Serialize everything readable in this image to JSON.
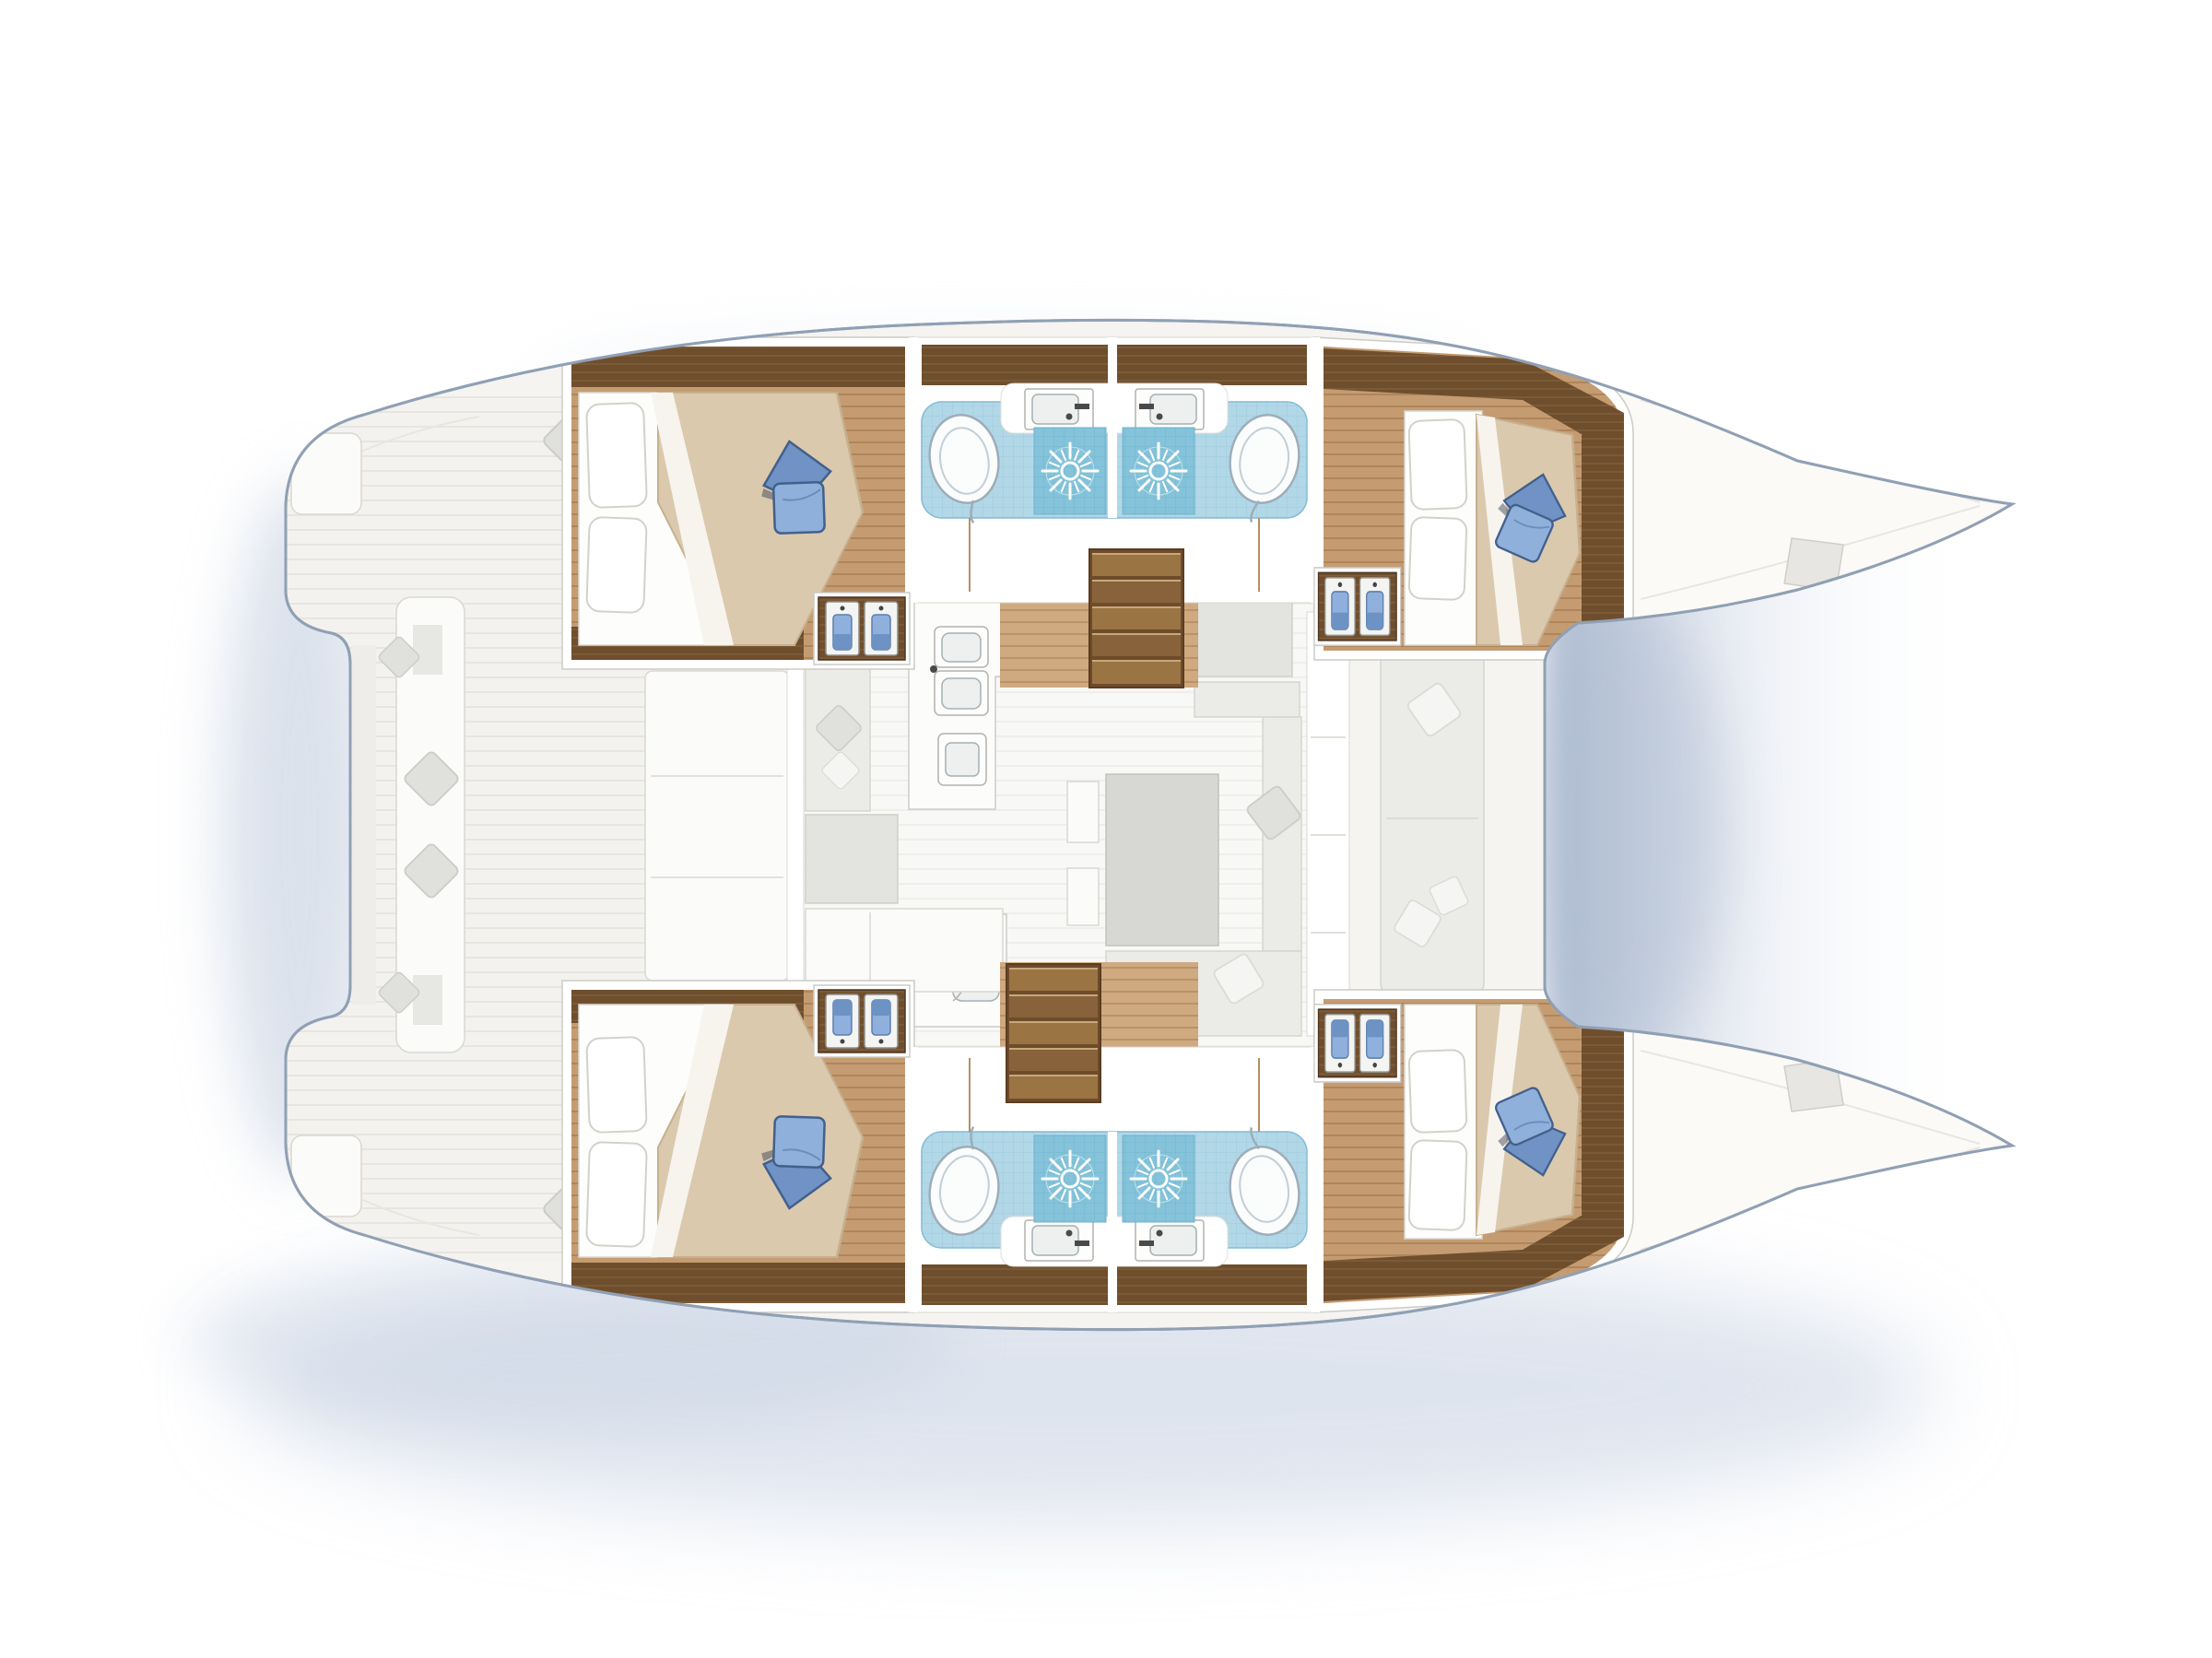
{
  "figure": {
    "type": "floor-plan",
    "subject": "catamaran-yacht-interior-layout-top-view",
    "orientation": "bow-right-stern-left",
    "hulls": 2,
    "rooms": {
      "cabins": [
        {
          "id": "port-aft-cabin",
          "position": "top-left",
          "features": [
            "double-bed",
            "white-pillows",
            "blue-accent-pillow",
            "beige-duvet",
            "wood-floor",
            "wardrobe"
          ]
        },
        {
          "id": "port-forward-cabin",
          "position": "top-right",
          "features": [
            "double-bed",
            "white-pillows",
            "blue-accent-pillow",
            "beige-duvet",
            "wood-floor",
            "wardrobe"
          ]
        },
        {
          "id": "starboard-aft-cabin",
          "position": "bottom-left",
          "features": [
            "double-bed",
            "white-pillows",
            "blue-accent-pillow",
            "beige-duvet",
            "wood-floor",
            "wardrobe"
          ]
        },
        {
          "id": "starboard-forward-cabin",
          "position": "bottom-right",
          "features": [
            "double-bed",
            "white-pillows",
            "blue-accent-pillow",
            "beige-duvet",
            "wood-floor",
            "wardrobe"
          ]
        }
      ],
      "bathrooms": [
        {
          "id": "port-aft-head",
          "fixtures": [
            "toilet",
            "washbasin",
            "shower-with-drain"
          ],
          "floor": "blue-mosaic-tile"
        },
        {
          "id": "port-forward-head",
          "fixtures": [
            "toilet",
            "washbasin",
            "shower-with-drain"
          ],
          "floor": "blue-mosaic-tile"
        },
        {
          "id": "starboard-aft-head",
          "fixtures": [
            "toilet",
            "washbasin",
            "shower-with-drain"
          ],
          "floor": "blue-mosaic-tile"
        },
        {
          "id": "starboard-forward-head",
          "fixtures": [
            "toilet",
            "washbasin",
            "shower-with-drain"
          ],
          "floor": "blue-mosaic-tile"
        }
      ],
      "saloon": {
        "features": [
          "galley-with-stove-and-double-sink",
          "oven",
          "island-unit",
          "dinette-table",
          "u-shaped-sofa",
          "stools",
          "forward-settee",
          "companionway-stairs-port",
          "companionway-stairs-starboard"
        ]
      },
      "exterior": [
        "aft-cockpit-with-benches-and-cushions",
        "transom-steps",
        "side-decks",
        "foredecks-with-hatches",
        "trampoline-gap-between-bows"
      ]
    },
    "counts": {
      "cabins": 4,
      "heads": 4,
      "showers": 4,
      "toilets": 4,
      "washbasins": 4,
      "companionway_stairs": 2,
      "wardrobes": 4
    }
  },
  "colors": {
    "background": "#ffffff",
    "shadow": "#b9c6da",
    "hull_outline": "#90a0b4",
    "hull_fill": "#f5f4f1",
    "deck_base": "#f3f2ef",
    "deck_seam": "#e7e5e0",
    "saloon_floor": "#f8f8f6",
    "saloon_seam": "#efeeea",
    "wood_floor": "#c59c72",
    "wood_seam": "#af865b",
    "wood_corridor": "#cfa980",
    "wood_corridor_seam": "#ba9268",
    "wood_dark": "#6f4e2d",
    "wood_dark_seam": "#7f5d39",
    "tile_blue": "#b2d8e8",
    "tile_grid": "#9ccadd",
    "shower_blue": "#84c3da",
    "shower_grid": "#74b6cf",
    "fixture_white": "#fbfcfc",
    "fixture_outline": "#9dadb9",
    "duvet": "#dbc9ae",
    "duvet_shade": "#c6b08e",
    "pillow_blue": "#7092c4",
    "pillow_blue_dark": "#42608c",
    "hanging_blue": "#8fb0dc",
    "stove_gray": "#c9c9c6"
  }
}
